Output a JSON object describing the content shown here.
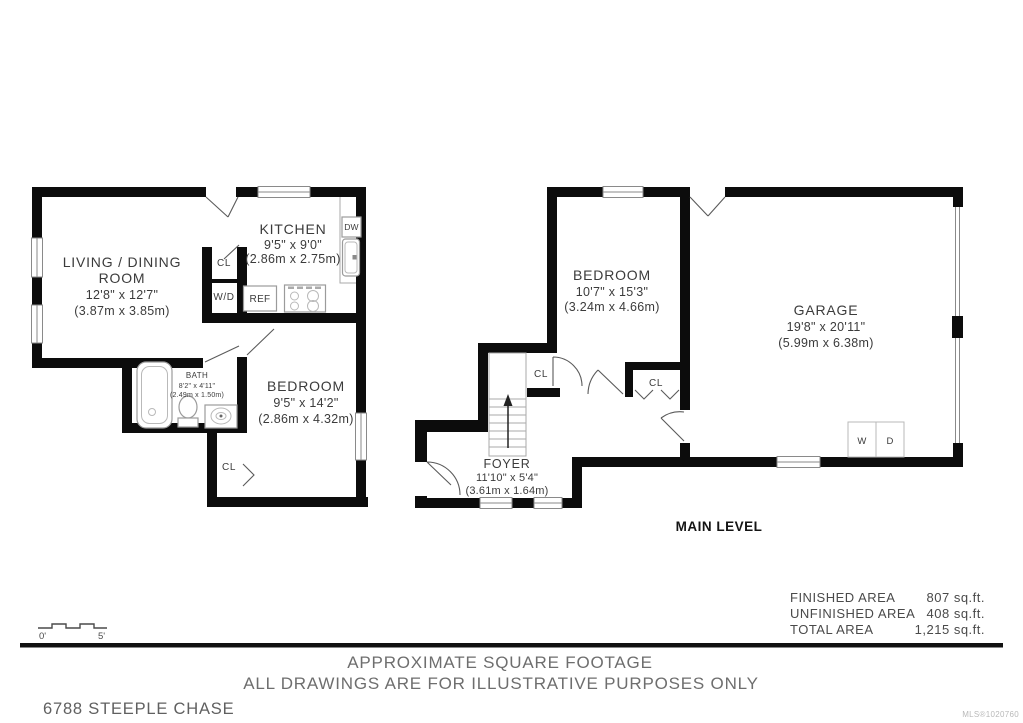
{
  "plans": {
    "left": {
      "rooms": {
        "living": {
          "name_line1": "LIVING / DINING",
          "name_line2": "ROOM",
          "imperial": "12'8\" x 12'7\"",
          "metric": "(3.87m x 3.85m)"
        },
        "kitchen": {
          "name": "KITCHEN",
          "imperial": "9'5\" x 9'0\"",
          "metric": "(2.86m x 2.75m)"
        },
        "bath": {
          "name": "BATH",
          "imperial": "8'2\" x 4'11\"",
          "metric": "(2.49m x 1.50m)"
        },
        "bedroom": {
          "name": "BEDROOM",
          "imperial": "9'5\" x 14'2\"",
          "metric": "(2.86m x 4.32m)"
        }
      },
      "labels": {
        "closet": "CL",
        "washer_dryer": "W/D",
        "fridge": "REF",
        "dishwasher": "DW",
        "bedroom_closet": "CL"
      }
    },
    "main": {
      "level_label": "MAIN LEVEL",
      "rooms": {
        "bedroom": {
          "name": "BEDROOM",
          "imperial": "10'7\" x 15'3\"",
          "metric": "(3.24m x 4.66m)"
        },
        "garage": {
          "name": "GARAGE",
          "imperial": "19'8\" x 20'11\"",
          "metric": "(5.99m x 6.38m)"
        },
        "foyer": {
          "name": "FOYER",
          "imperial": "11'10\" x 5'4\"",
          "metric": "(3.61m x 1.64m)"
        }
      },
      "labels": {
        "closet1": "CL",
        "closet2": "CL",
        "washer": "W",
        "dryer": "D"
      }
    }
  },
  "area_table": {
    "rows": [
      {
        "label": "FINISHED AREA",
        "value": "807 sq.ft."
      },
      {
        "label": "UNFINISHED AREA",
        "value": "408 sq.ft."
      },
      {
        "label": "TOTAL AREA",
        "value": "1,215 sq.ft."
      }
    ]
  },
  "scale_bar": {
    "start_label": "0'",
    "end_label": "5'"
  },
  "footer": {
    "line1": "APPROXIMATE SQUARE FOOTAGE",
    "line2": "ALL DRAWINGS ARE FOR ILLUSTRATIVE PURPOSES ONLY",
    "address": "6788 STEEPLE CHASE",
    "mls": "MLS®1020760"
  },
  "colors": {
    "wall": "#0c0c0c",
    "plan_text": "#3b3b3b",
    "fixture_line": "#9b9b9b",
    "footer_text": "#6e6e6e"
  }
}
